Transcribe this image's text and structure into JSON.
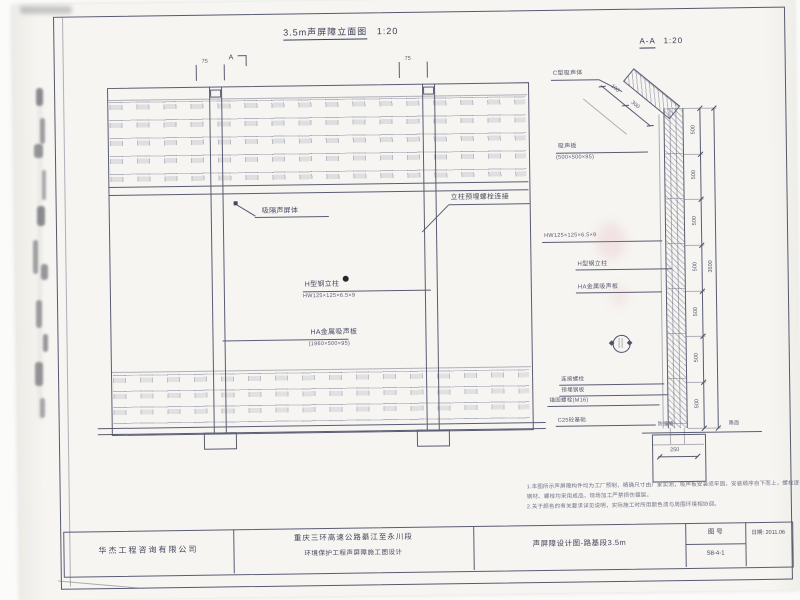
{
  "sheet": {
    "elevation_title": "3.5m声屏障立面图",
    "elevation_scale": "1:20",
    "section_title": "A-A",
    "section_scale": "1:20"
  },
  "elevation": {
    "cut_label": "A",
    "tick_dim": "75",
    "labels": {
      "panel": "吸隔声屏体",
      "column_bolt": "立柱预埋螺栓连接",
      "h_column": "H型钢立柱",
      "h_column_spec": "HW125×125×6.5×9",
      "absorber": "HA金属吸声板",
      "absorber_spec": "(1960×500×95)"
    }
  },
  "section": {
    "labels": {
      "top_absorber": "C型吸声体",
      "panel": "吸声板",
      "panel_spec": "(500×500×95)",
      "column_spec": "HW125×125×6.5×9",
      "h_column": "H型钢立柱",
      "metal_panel": "HA金属吸声板",
      "bolt": "连接螺栓",
      "embed_plate": "预埋钢板",
      "anchor_bolt": "锚固螺栓(M16)",
      "foundation": "C25砼基础",
      "wall": "防撞墙",
      "road": "路面"
    },
    "dims": {
      "segment": "500",
      "total": "3500",
      "incline_a": "100",
      "incline_b": "300",
      "footing_width": "250"
    }
  },
  "notes": {
    "line1": "1.本图所示声屏障构件均为工厂预制，精确尺寸由厂家实测，吸声板安装须牢固，安装顺序自下而上，螺栓逐个拧紧，",
    "line2": "  钢材、螺栓均采用成品，现场加工严禁损伤镀层。",
    "line3": "2.关于颜色的有关要求详见说明，实际施工时所用颜色须与周围环境相协调。"
  },
  "titleblock": {
    "company": "华杰工程咨询有限公司",
    "project_line1": "重庆三环高速公路綦江至永川段",
    "project_line2": "环境保护工程声屏障施工图设计",
    "drawing_title": "声屏障设计图-路基段3.5m",
    "sheet_no_label": "图  号",
    "sheet_no": "S8-4-1",
    "date": "日期: 2011.06"
  }
}
